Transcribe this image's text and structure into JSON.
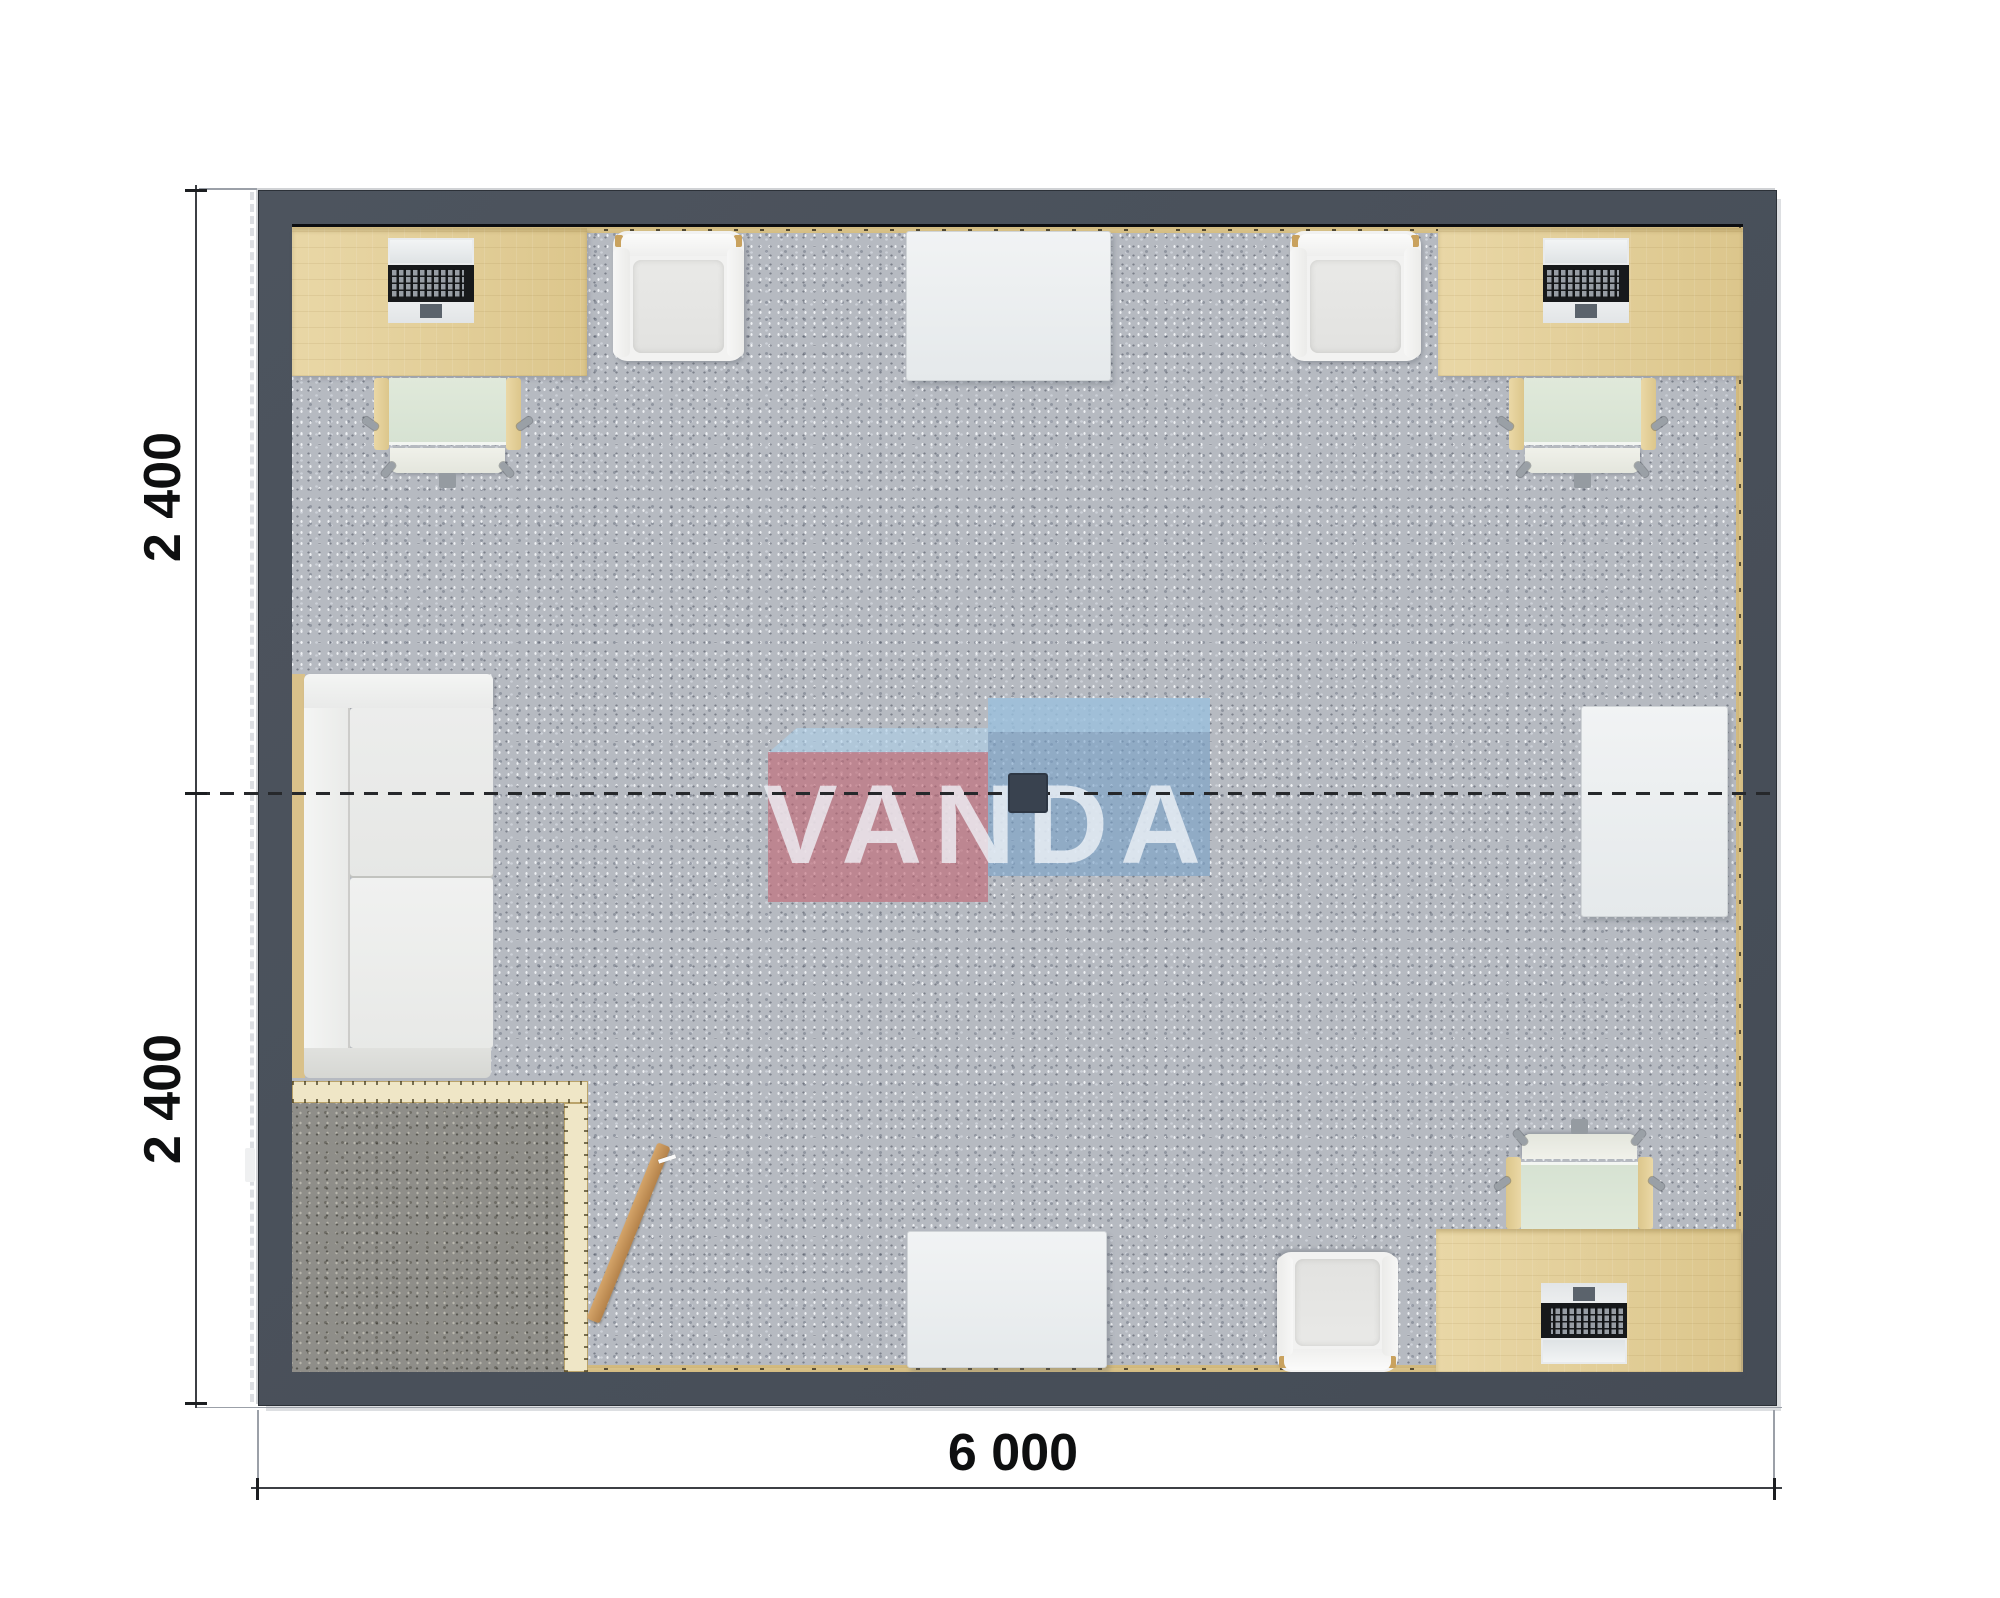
{
  "drawing": {
    "type": "architectural floor plan, top-down 3D render",
    "annotations": {
      "dim_left_top": "2 400",
      "dim_left_bottom": "2 400",
      "dim_bottom": "6 000"
    },
    "watermark": {
      "text": "VANDA"
    },
    "colors": {
      "wall": "#49505a",
      "floor_carpet": "#b6bac1",
      "vestibule_carpet": "#8f8e89",
      "desk_wood": "#e2cf99",
      "partition_wood": "#efe6c6",
      "door_wood": "#c0925c",
      "chair_seat_green": "#dde7d8",
      "dimension_text": "#0e0f10",
      "watermark_red": "#c16472",
      "watermark_blue": "#79a1c8",
      "watermark_light_blue": "#adcfe8"
    },
    "rooms": [
      {
        "name": "open office"
      },
      {
        "name": "entry vestibule (bottom-left)"
      }
    ],
    "furniture": [
      {
        "item": "desk with laptop",
        "location": "top-left"
      },
      {
        "item": "office chair",
        "location": "top-left"
      },
      {
        "item": "armchair",
        "location": "top-left-of-center"
      },
      {
        "item": "square table",
        "location": "top-center"
      },
      {
        "item": "armchair",
        "location": "top-right-of-center"
      },
      {
        "item": "desk with laptop",
        "location": "top-right"
      },
      {
        "item": "office chair",
        "location": "top-right"
      },
      {
        "item": "side table",
        "location": "right-middle"
      },
      {
        "item": "sofa",
        "location": "left-middle"
      },
      {
        "item": "open door leaf",
        "location": "vestibule"
      },
      {
        "item": "square table",
        "location": "bottom-center"
      },
      {
        "item": "armchair",
        "location": "bottom-center-right"
      },
      {
        "item": "desk with laptop",
        "location": "bottom-right"
      },
      {
        "item": "office chair",
        "location": "bottom-right"
      },
      {
        "item": "ceiling lamp",
        "location": "center"
      }
    ]
  }
}
